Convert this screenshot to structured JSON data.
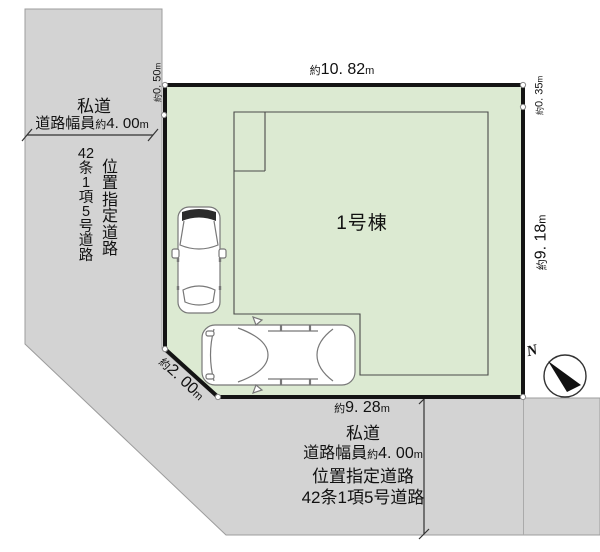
{
  "site_plan": {
    "building_label": "1号棟",
    "compass": {
      "north_label": "N"
    },
    "dimensions": {
      "top": {
        "prefix": "約",
        "value": "10. 82",
        "unit": "m"
      },
      "right": {
        "prefix": "約",
        "value": "9. 18",
        "unit": "m"
      },
      "bottom": {
        "prefix": "約",
        "value": "9. 28",
        "unit": "m"
      },
      "diagonal": {
        "prefix": "約",
        "value": "2. 00",
        "unit": "m"
      },
      "left_offset": {
        "prefix": "約",
        "value": "0. 50",
        "unit": "m"
      },
      "right_offset": {
        "prefix": "約",
        "value": "0. 35",
        "unit": "m"
      }
    },
    "left_road": {
      "name": "私道",
      "width_label": "道路幅員",
      "width_prefix": "約",
      "width_value": "4. 00",
      "width_unit": "m",
      "vertical_col_article": [
        "42",
        "条",
        "1",
        "項",
        "5",
        "号",
        "道",
        "路"
      ],
      "vertical_col_designation": [
        "位",
        "置",
        "指",
        "定",
        "道",
        "路"
      ]
    },
    "bottom_road": {
      "name": "私道",
      "width_label": "道路幅員",
      "width_prefix": "約",
      "width_value": "4. 00",
      "width_unit": "m",
      "designation": "位置指定道路",
      "article": "42条1項5号道路"
    },
    "colors": {
      "plot_fill": "#dcead2",
      "road_fill": "#d3d3d3",
      "road_edge": "#9c9c9c",
      "plot_border": "#141414"
    }
  }
}
